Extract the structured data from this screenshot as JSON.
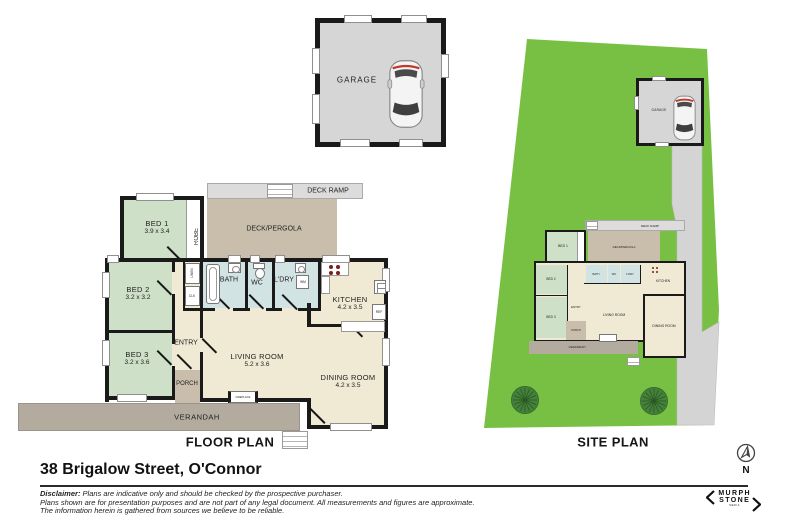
{
  "address": "38 Brigalow Street, O'Connor",
  "floor_plan": {
    "title": "FLOOR PLAN",
    "garage": "GARAGE",
    "deck_ramp": "DECK RAMP",
    "deck_pergola": "DECK/PERGOLA",
    "verandah": "VERANDAH",
    "porch": "PORCH",
    "entry": "ENTRY",
    "robe": "ROBE",
    "linen": "LINEN",
    "clk": "CLK",
    "bath": "BATH",
    "wc": "WC",
    "ldry": "L'DRY",
    "wm": "WM",
    "ref": "REF",
    "fireplace": "FIREPLACE",
    "rooms": {
      "bed1": {
        "label": "BED 1",
        "dims": "3.9 x 3.4"
      },
      "bed2": {
        "label": "BED 2",
        "dims": "3.2 x 3.2"
      },
      "bed3": {
        "label": "BED 3",
        "dims": "3.2 x 3.6"
      },
      "kitchen": {
        "label": "KITCHEN",
        "dims": "4.2 x 3.5"
      },
      "living": {
        "label": "LIVING ROOM",
        "dims": "5.2 x 3.6"
      },
      "dining": {
        "label": "DINING ROOM",
        "dims": "4.2 x 3.5"
      }
    }
  },
  "site_plan": {
    "title": "SITE PLAN"
  },
  "compass": {
    "north": "N"
  },
  "logo": {
    "line1": "MURPH",
    "line2": "STONE",
    "sub": "MEDIA"
  },
  "disclaimer": {
    "label": "Disclaimer:",
    "line1": "Plans are indicative only and should be checked by the prospective purchaser.",
    "line2": "Plans shown are for presentation purposes and are not part of any legal document. All measurements and figures are approximate.",
    "line3": "The information herein is gathered from sources we believe to be reliable."
  },
  "colors": {
    "bedroom_green": "#cfe0c8",
    "wet_blue": "#d2e3e4",
    "living_cream": "#f0e9d4",
    "deck_taupe": "#c9beac",
    "verandah_grey": "#b2ab9e",
    "hardstand_grey": "#d6d6d6",
    "grass_green": "#78c043",
    "tree_green": "#45813a",
    "wall_black": "#1a1a1a",
    "cooktop_red": "#7c1d1d"
  }
}
